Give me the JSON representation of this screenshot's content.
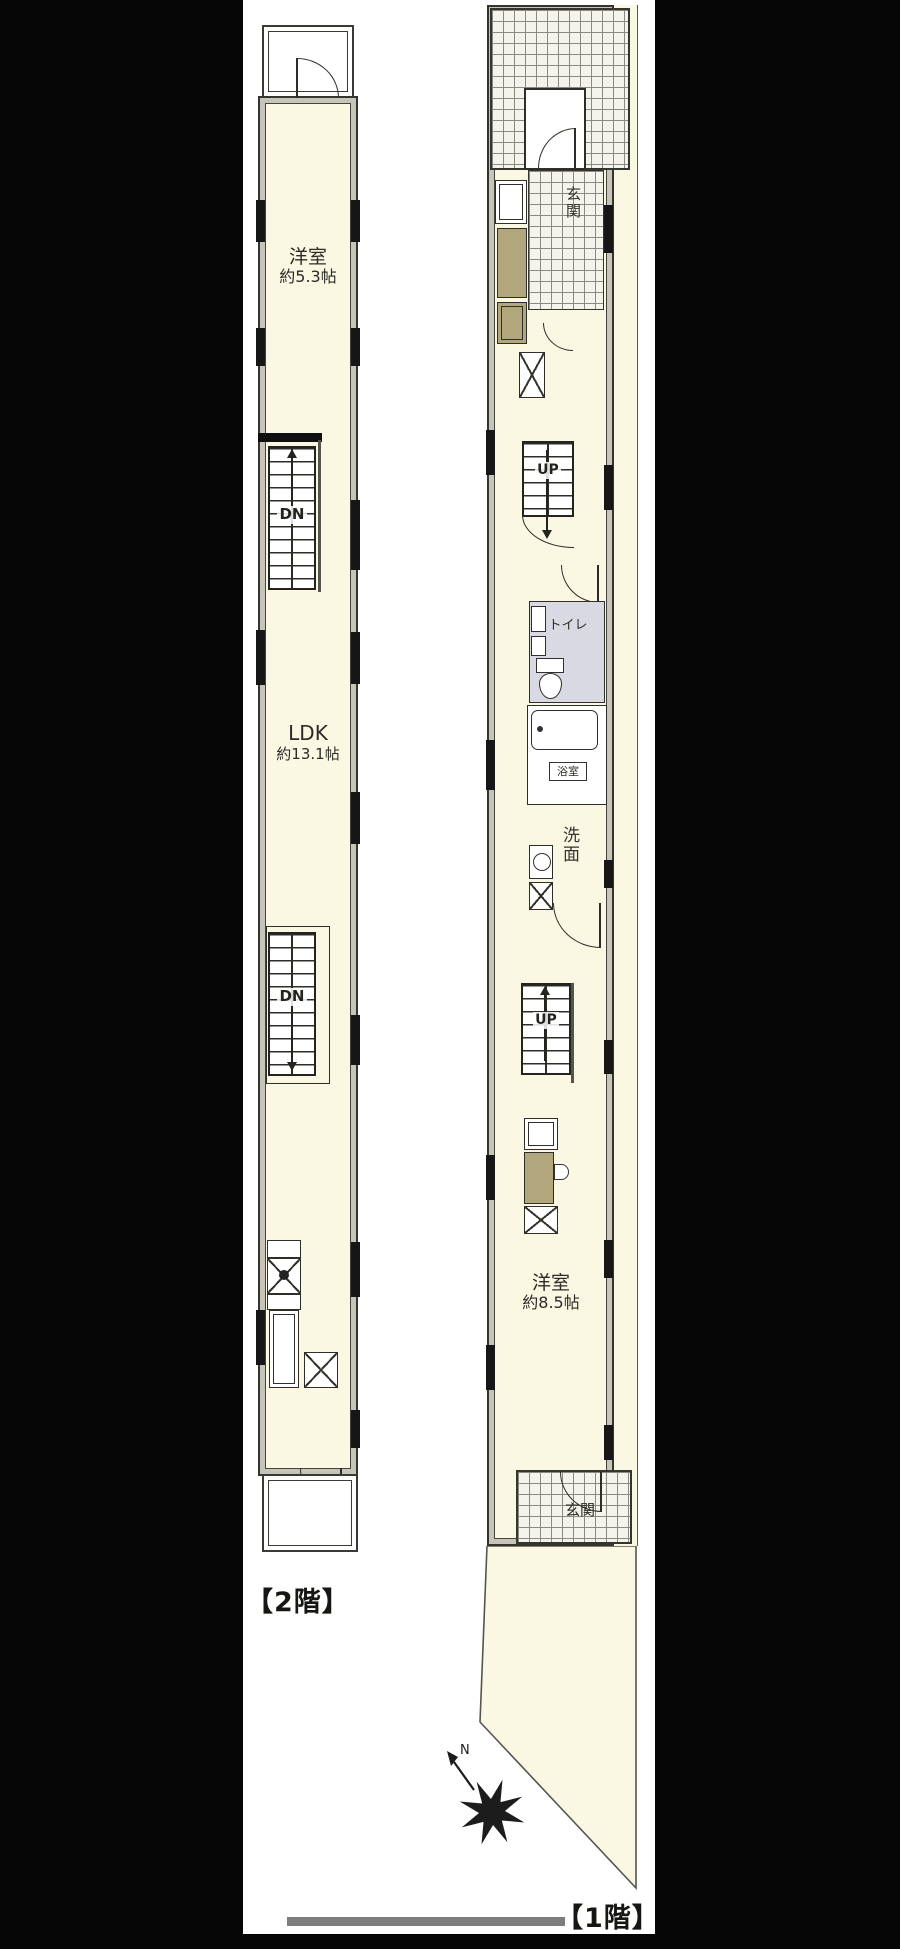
{
  "colors": {
    "canvas_bg": "#000000",
    "panel_bg": "#ffffff",
    "floor_fill": "#faf8e2",
    "wall_fill": "#c7c5ba",
    "line": "#35352f",
    "toilet_floor": "#d9d9e3",
    "cabinet_tan": "#b1a67c",
    "scrollbar_gray": "#7e7e7e"
  },
  "floor2": {
    "caption": "【2階】",
    "room1_name": "洋室",
    "room1_size": "約5.3帖",
    "ldk_name": "LDK",
    "ldk_size": "約13.1帖",
    "stair_top_label": "DN",
    "stair_mid_label": "DN"
  },
  "floor1": {
    "caption": "【1階】",
    "entrance_top_label": "玄関",
    "stair_upper_label": "UP",
    "toilet_label": "トイレ",
    "bath_label": "浴室",
    "washroom_label": "洗面",
    "stair_lower_label": "UP",
    "room_name": "洋室",
    "room_size": "約8.5帖",
    "entrance_bottom_label": "玄関"
  },
  "compass": {
    "north_label": "N"
  }
}
